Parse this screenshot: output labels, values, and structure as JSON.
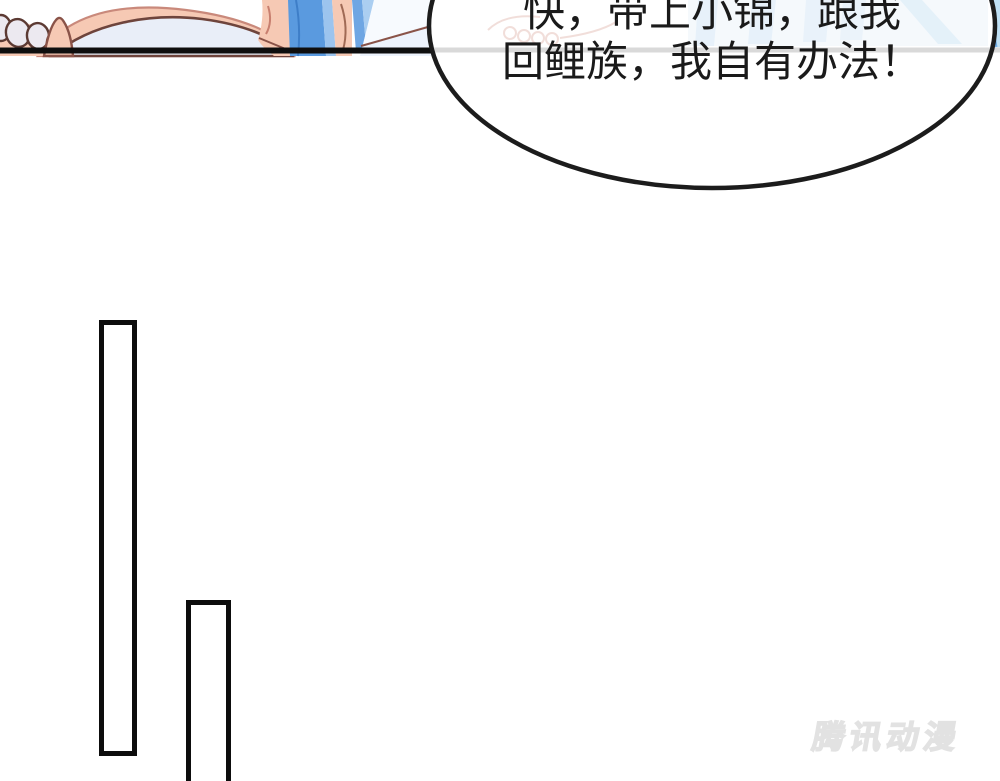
{
  "comic": {
    "speech_bubble": {
      "line1": "快，带上小锦，跟我",
      "line2": "回鲤族，我自有办法！"
    },
    "watermark": {
      "text": "腾讯动漫"
    },
    "colors": {
      "panel_border_black": "#0e0e0e",
      "divider_gray": "#d9d9d9",
      "bubble_outline": "#1c1c1c",
      "bubble_fill": "#ffffff",
      "speech_text": "#1a1a1a",
      "skin": "#f6c9b4",
      "skin_outline": "#8a5348",
      "toenail": "#ece9f0",
      "cloth_lavender": "#e9eef8",
      "hair_blue": "#5a9adf",
      "hair_blue_light": "#9cc4ee",
      "background_blue_light": "#d6ebf8",
      "watermark_gray": "#e2e2e2"
    }
  }
}
